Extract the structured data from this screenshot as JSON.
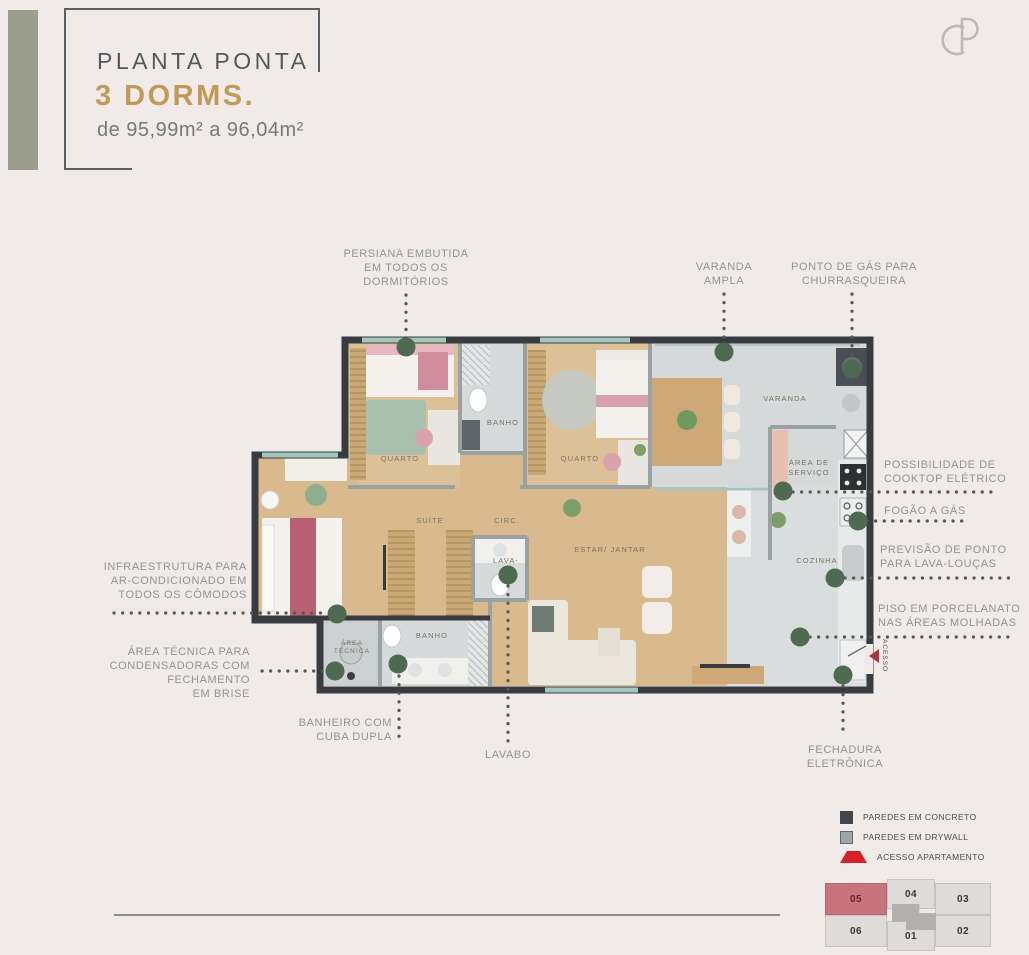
{
  "header": {
    "title": "PLANTA PONTA",
    "dorms": "3 DORMS.",
    "area": "de 95,99m² a 96,04m²"
  },
  "logo": {
    "monogram": "CP"
  },
  "rooms": {
    "quarto1": "QUARTO",
    "banho1": "BANHO",
    "quarto2": "QUARTO",
    "varanda": "VARANDA",
    "area_servico": "ÁREA DE\nSERVIÇO",
    "cozinha": "COZINHA",
    "estar_jantar": "ESTAR/ JANTAR",
    "suite": "SUÍTE",
    "circ": "CIRC.",
    "lavabo": "LAVA-",
    "banho2": "BANHO",
    "area_tecnica": "ÁREA\nTÉCNICA",
    "acesso": "ACESSO"
  },
  "annotations": {
    "persiana": "PERSIANA EMBUTIDA\nEM TODOS OS\nDORMITÓRIOS",
    "varanda_ampla": "VARANDA\nAMPLA",
    "ponto_gas": "PONTO DE GÁS PARA\nCHURRASQUEIRA",
    "cooktop": "POSSIBILIDADE DE\nCOOKTOP ELÉTRICO",
    "fogao": "FOGÃO A GÁS",
    "lava_loucas": "PREVISÃO DE PONTO\nPARA LAVA-LOUÇAS",
    "piso": "PISO EM PORCELANATO\nNAS ÁREAS MOLHADAS",
    "infra_ac": "INFRAESTRUTURA PARA\nAR-CONDICIONADO EM\nTODOS OS CÔMODOS",
    "area_tecnica": "ÁREA TÉCNICA PARA\nCONDENSADORAS COM\nFECHAMENTO\nEM BRISE",
    "banheiro_cuba": "BANHEIRO COM\nCUBA DUPLA",
    "lavabo": "LAVABO",
    "fechadura": "FECHADURA\nELETRÔNICA"
  },
  "legend": {
    "concreto": "PAREDES EM CONCRETO",
    "drywall": "PAREDES EM DRYWALL",
    "acesso": "ACESSO APARTAMENTO"
  },
  "key_plan": {
    "units": [
      {
        "number": "05",
        "highlighted": true
      },
      {
        "number": "04",
        "highlighted": false
      },
      {
        "number": "03",
        "highlighted": false
      },
      {
        "number": "06",
        "highlighted": false
      },
      {
        "number": "01",
        "highlighted": false
      },
      {
        "number": "02",
        "highlighted": false
      }
    ]
  },
  "colors": {
    "accent_gold": "#c09a58",
    "annotation_green": "#4e6a51",
    "highlight_unit": "#c9747c",
    "legend_red": "#d6212b",
    "concrete_wall": "#43474c",
    "drywall_wall": "#9fa5a8"
  }
}
